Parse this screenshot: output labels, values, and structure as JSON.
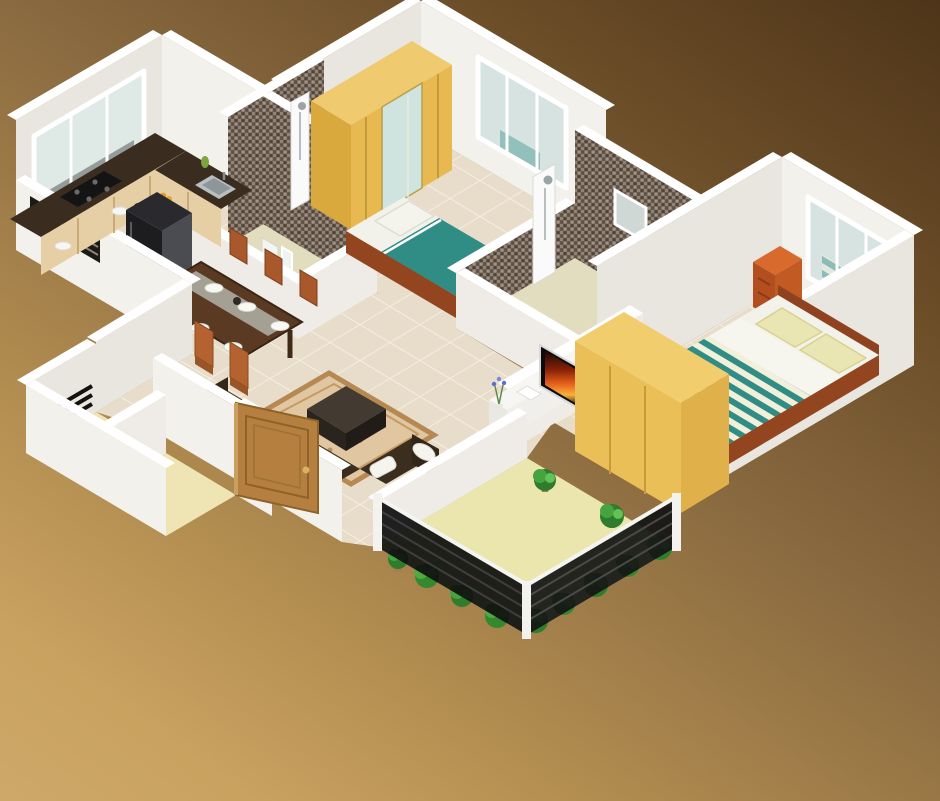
{
  "scene": {
    "label": "3D isometric floor plan render of a 2-bedroom house",
    "style": "isometric 3D cutaway, no visible text",
    "background": "brown-to-tan diagonal gradient"
  },
  "palette": {
    "background_dark": "#4e3519",
    "background_light": "#cda868",
    "wall_white": "#f3f1ec",
    "wall_shade": "#e9e6e0",
    "floor_tile": "#e8ddcb",
    "tile_grout": "#f7f0e2",
    "bathroom_floor": "#e3ddbf",
    "balcony_floor": "#ebe6ae",
    "foyer_floor": "#efe5b4",
    "mosaic_tile": "#6e6156",
    "teal_bedding": "#2f8d85",
    "bed_frame_wood": "#a8502c",
    "wardrobe_wood": "#e7b950",
    "sofa_brown": "#37291a",
    "counter_top": "#3a2d20",
    "cabinet_wood": "#e6cfa5",
    "dining_wood": "#5a3a22",
    "chair_wood": "#b4622f",
    "door_wood": "#b5803f",
    "plant_green": "#3f9d3a",
    "tv_fire_orange": "#e8611c",
    "fridge_black": "#1d1d20",
    "nightstand_orange": "#c25a24",
    "rug_tan": "#e0c7a2"
  },
  "rooms": {
    "kitchen": {
      "label": "Kitchen",
      "items": [
        "L-shaped counter with dark top",
        "gas cooktop",
        "steel sink",
        "wide sliding window",
        "black refrigerator",
        "fruit, jars and plates"
      ]
    },
    "dining": {
      "label": "Dining area",
      "items": [
        "six-seat dark wood dining table",
        "six orange-wood chairs",
        "white plates",
        "glass runner"
      ]
    },
    "bedroom_small": {
      "label": "Bedroom 2",
      "items": [
        "single bed with teal bedding and white pillow",
        "sliding wardrobe with mirror",
        "back window"
      ]
    },
    "bathroom_main": {
      "label": "Bathroom 1",
      "items": [
        "mosaic tiled walls",
        "shower panel",
        "wash basin",
        "toilet",
        "small window"
      ]
    },
    "bathroom_attached": {
      "label": "Bathroom 2",
      "items": [
        "tall mosaic wall with small window",
        "white shower panel",
        "toilet",
        "half-height walls"
      ]
    },
    "bedroom_master": {
      "label": "Master bedroom",
      "items": [
        "double bed with teal-and-white striped bedding",
        "two pale pillows",
        "orange nightstand",
        "yellow wood wardrobe",
        "three-pane window"
      ]
    },
    "living": {
      "label": "Living room",
      "items": [
        "L-shaped dark brown sofa with white cushions",
        "patterned rug",
        "dark coffee table",
        "glowing table lamp",
        "white TV console",
        "flat TV with fiery screen",
        "blue flowers"
      ]
    },
    "balcony": {
      "label": "Balcony",
      "items": [
        "pale yellow floor",
        "dark louvered glass railing",
        "row of potted green plants"
      ]
    },
    "foyer": {
      "label": "Entrance foyer",
      "items": [
        "open wooden entry door with gold knob",
        "two small storage rooms",
        "dark ventilation grille"
      ]
    }
  }
}
